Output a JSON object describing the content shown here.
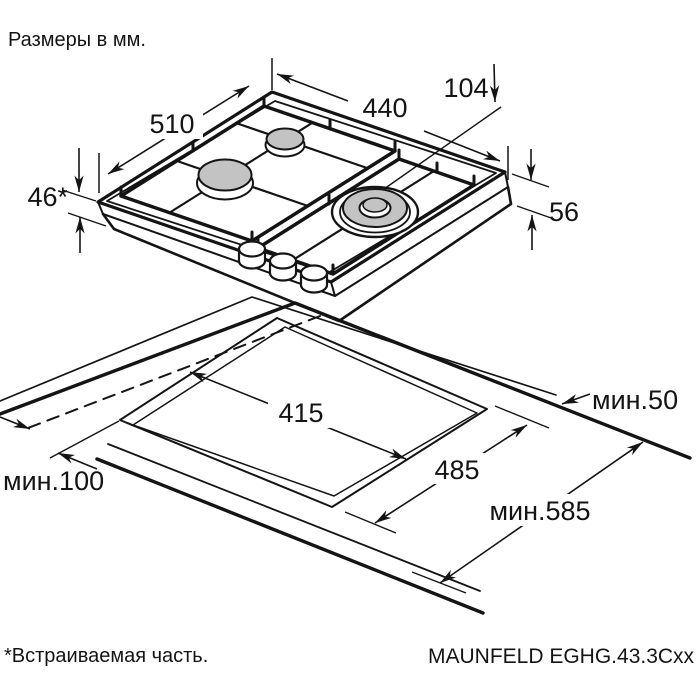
{
  "page": {
    "title": "Размеры в мм.",
    "footnote": "*Встраиваемая часть.",
    "model": "MAUNFELD EGHG.43.3Cxx"
  },
  "dimensions": {
    "hob": {
      "depth": "510",
      "width": "440",
      "burner_offset": "104",
      "builtin_height": "46*",
      "body_height": "56"
    },
    "installation": {
      "cutout_width": "415",
      "cutout_depth": "485",
      "rear_clearance": "мин.50",
      "side_clearance": "мин.100",
      "min_counter_depth": "мин.585"
    }
  },
  "colors": {
    "line": "#141414",
    "burner": "#c3c3c3",
    "background": "#ffffff"
  }
}
